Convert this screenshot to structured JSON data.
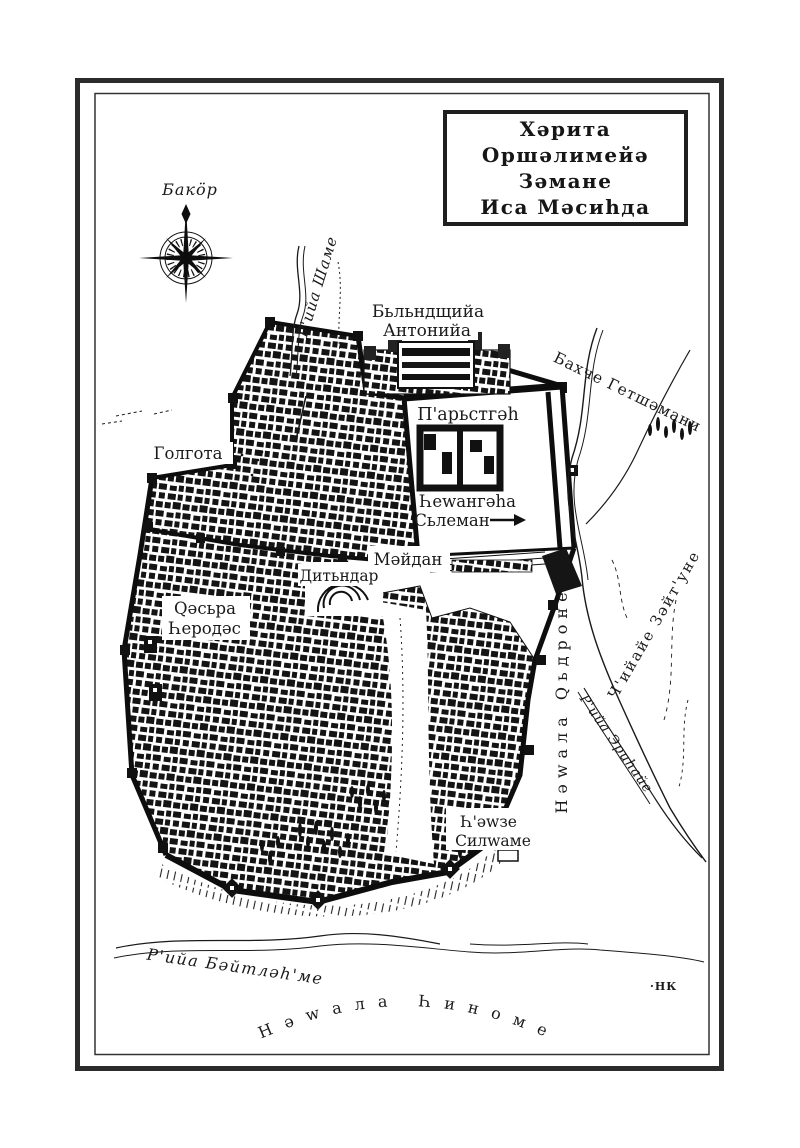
{
  "page": {
    "background": "#ffffff",
    "frame_color": "#2b2b2b",
    "ink_color": "#141414"
  },
  "title_box": {
    "lines": [
      "Хәрита",
      "Оршәлимейә",
      "Зәмане",
      "Иса Мәсиһда"
    ]
  },
  "compass": {
    "label": "Бакӧр"
  },
  "places": {
    "road_damascus": "Р'ийа Шаме",
    "antonia_line1": "Бьльндщийа",
    "antonia_line2": "Антонийа",
    "gethsemane": "Бахче Гетшәмани",
    "temple": "П'арьстгәһ",
    "solomon_line1": "Һеwангәһа",
    "solomon_line2": "Сьлеман",
    "golgotha": "Голгота",
    "maidan": "Мәйдан",
    "ditindar": "Дитьндар",
    "herod_line1": "Qәсьра",
    "herod_line2": "Һеродәс",
    "kidron_valley": "Нәwала Qьдроне",
    "mount_olives": "Ч'ийайе Зәйт'уне",
    "road_jericho": "Р'ийа Эриһайе",
    "siloam_line1": "Һ'әwзе",
    "siloam_line2": "Силwаме",
    "road_bethlehem": "Р'ийа Бәйтләһ'ме",
    "hinnom_valley": "Нәwала Һиноме",
    "signature": "·НК"
  }
}
